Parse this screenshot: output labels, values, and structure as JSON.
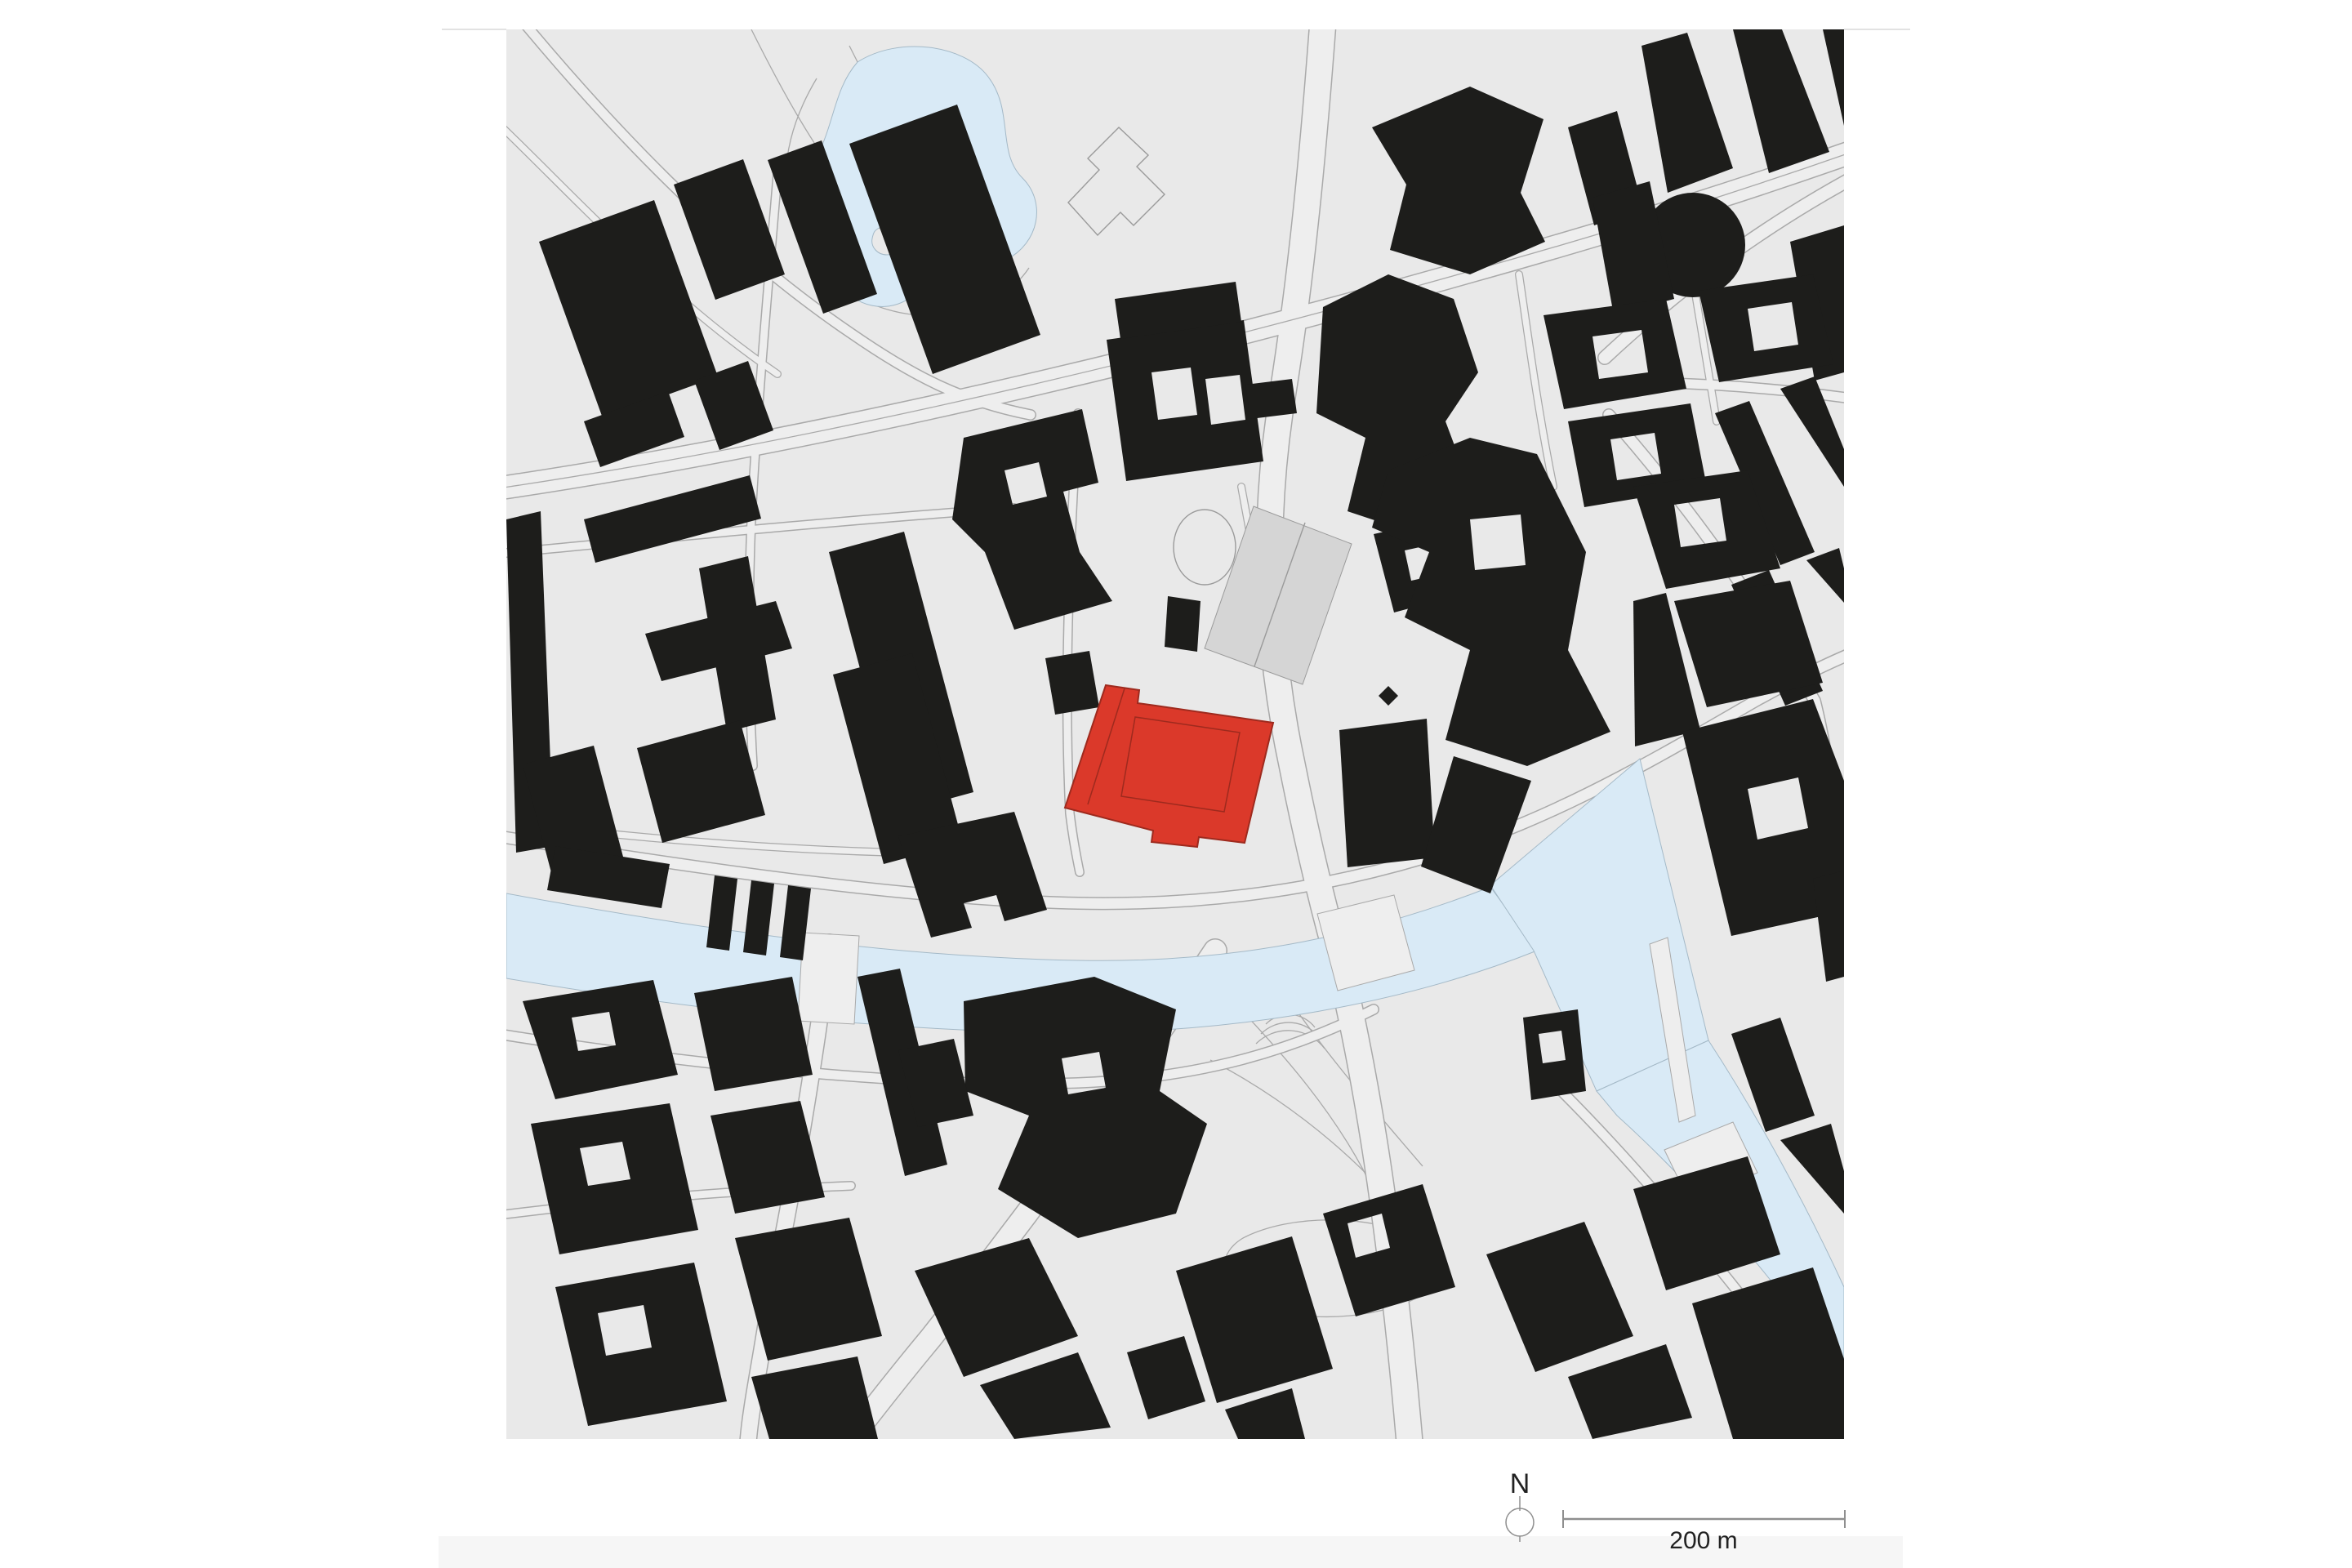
{
  "legend": {
    "north_label": "N",
    "scale_label": "200 m"
  },
  "colors": {
    "page-bg": "#ffffff",
    "map-bg": "#e9e9e9",
    "building": "#1d1d1b",
    "building-gray": "#d5d5d5",
    "highlight-red": "#db392a",
    "highlight-red-dark": "#9e2a1e",
    "water": "#d9eaf6",
    "water-edge": "#a4b9c7",
    "road-edge": "#a9a9a9",
    "road-fill": "#eeeeee",
    "outline": "#9a9a9a",
    "footer-strip": "#f6f6f6",
    "hairline": "#d9d9d9",
    "legend-ink": "#222222",
    "scale-line": "#8f8f8f"
  },
  "features": {
    "highlighted_building": "red-site-building",
    "tinted_building": "gray-building",
    "water_bodies": [
      "park-lake-with-island",
      "river",
      "triangular-basin",
      "southeast-canal"
    ],
    "landmarks": [
      "circular-building",
      "courtyard-palace",
      "outlined-cross-building"
    ],
    "annotations": [
      "north-indicator",
      "scale-bar"
    ]
  }
}
